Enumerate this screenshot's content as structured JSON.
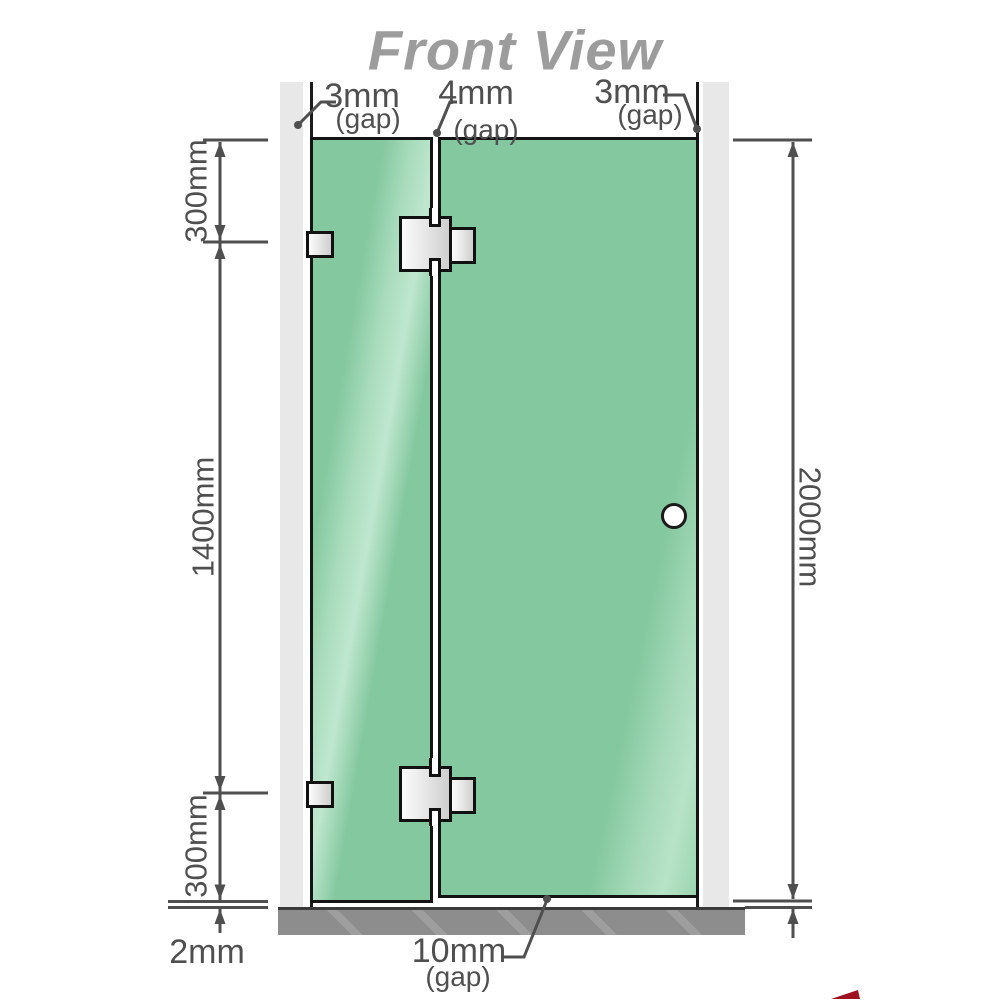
{
  "title": "Front View",
  "gap_labels": {
    "left": {
      "value": "3mm",
      "note": "(gap)"
    },
    "middle": {
      "value": "4mm",
      "note": "(gap)"
    },
    "right": {
      "value": "3mm",
      "note": "(gap)"
    },
    "bottom": {
      "value": "10mm",
      "note": "(gap)"
    }
  },
  "dimensions": {
    "left_top": "300mm",
    "left_middle": "1400mm",
    "left_bottom": "300mm",
    "right_total": "2000mm",
    "floor_clearance": "2mm"
  },
  "colors": {
    "glass": "#84c89f",
    "glass_outline": "#141414",
    "wall": "#e8e8e8",
    "floor": "#8d8d8d",
    "dimension_lines": "#4f4f4f",
    "title_text": "#9c9c9c",
    "hardware_fill": "#e8e8e8",
    "corner_mark": "#9c1220"
  }
}
